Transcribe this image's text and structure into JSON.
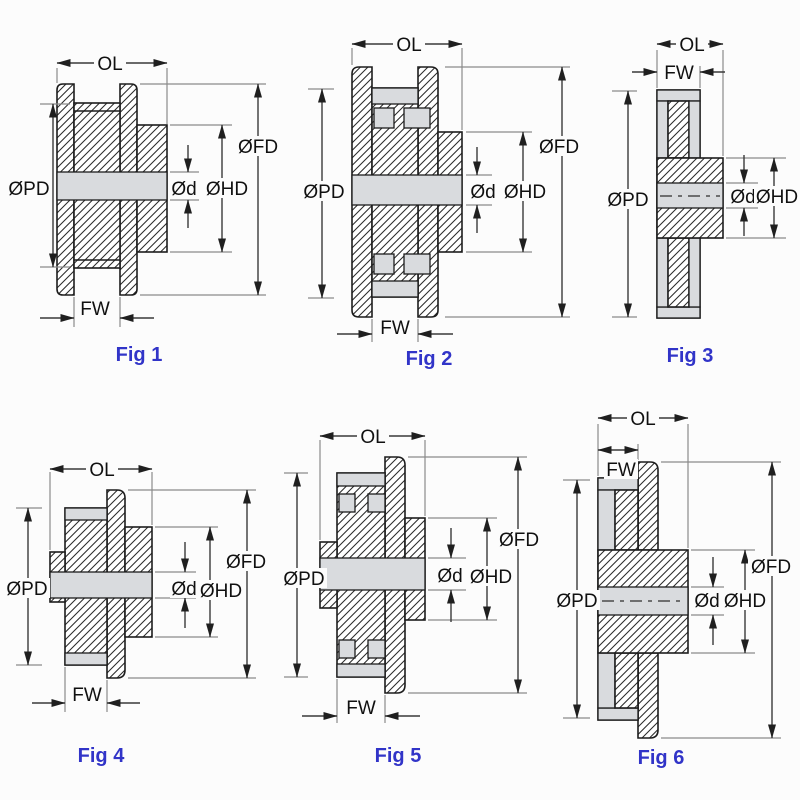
{
  "figures": [
    {
      "caption": "Fig 1",
      "dims": {
        "ol": "OL",
        "fw": "FW",
        "pd": "ØPD",
        "fd": "ØFD",
        "hd": "ØHD",
        "d": "Ød"
      }
    },
    {
      "caption": "Fig 2",
      "dims": {
        "ol": "OL",
        "fw": "FW",
        "pd": "ØPD",
        "fd": "ØFD",
        "hd": "ØHD",
        "d": "Ød"
      }
    },
    {
      "caption": "Fig 3",
      "dims": {
        "ol": "OL",
        "fw": "FW",
        "pd": "ØPD",
        "hd": "ØHD",
        "d": "Ød"
      }
    },
    {
      "caption": "Fig 4",
      "dims": {
        "ol": "OL",
        "fw": "FW",
        "pd": "ØPD",
        "fd": "ØFD",
        "hd": "ØHD",
        "d": "Ød"
      }
    },
    {
      "caption": "Fig 5",
      "dims": {
        "ol": "OL",
        "fw": "FW",
        "pd": "ØPD",
        "fd": "ØFD",
        "hd": "ØHD",
        "d": "Ød"
      }
    },
    {
      "caption": "Fig 6",
      "dims": {
        "ol": "OL",
        "fw": "FW",
        "pd": "ØPD",
        "fd": "ØFD",
        "hd": "ØHD",
        "d": "Ød"
      }
    }
  ],
  "colors": {
    "caption_blue": "#3134c8",
    "part_outline": "#1d1d1d",
    "dimension_line": "#3a3a3a",
    "extension_line": "#8a8a8a",
    "bore_fill": "#d9dbde",
    "background": "#fcfcfc"
  }
}
